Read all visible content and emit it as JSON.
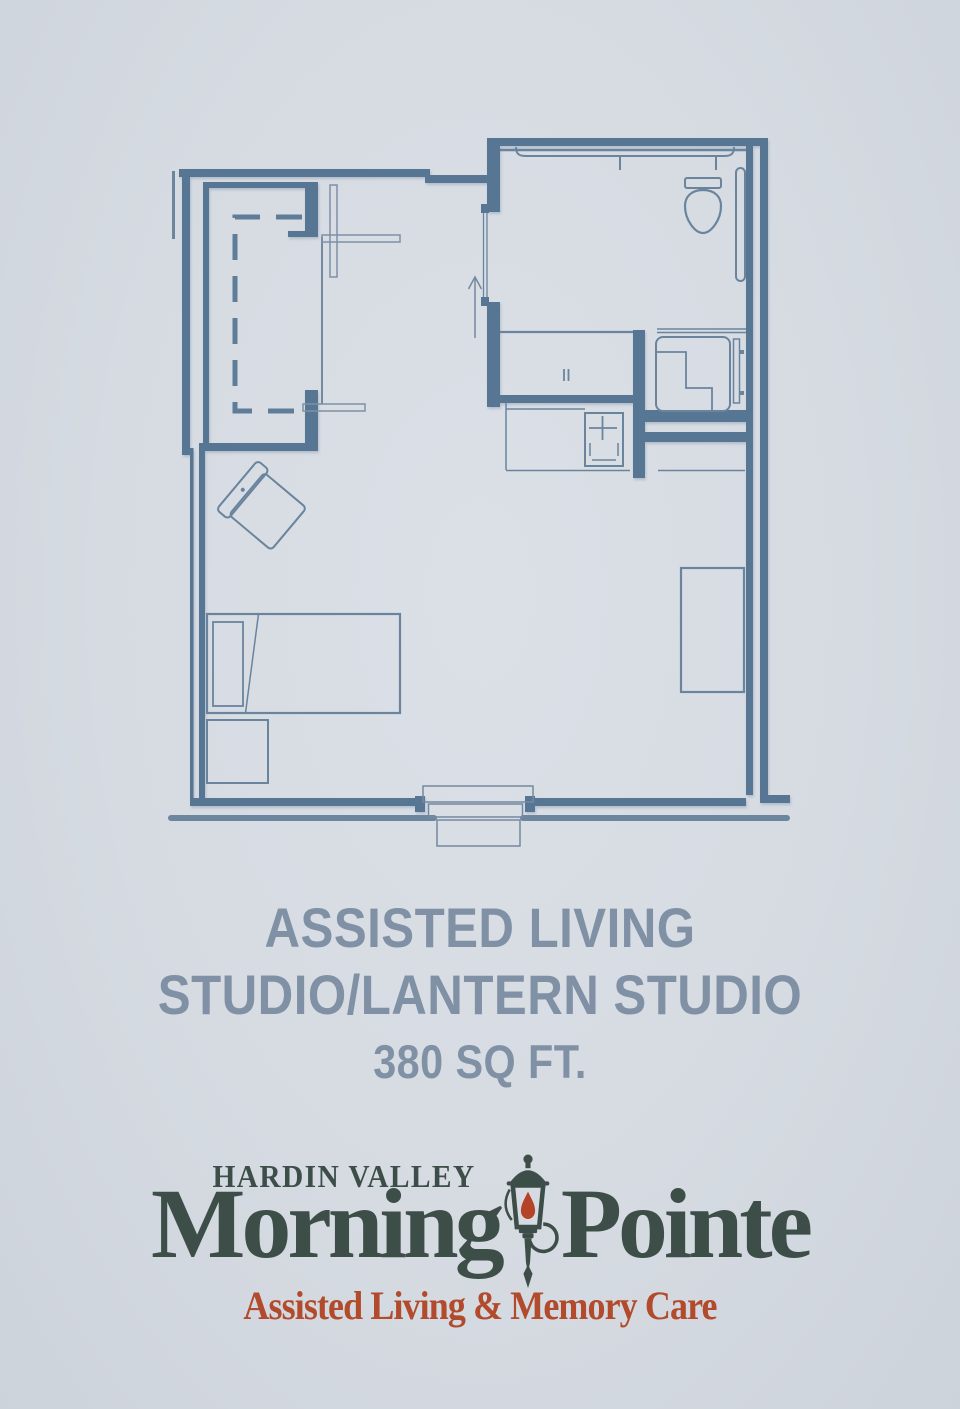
{
  "page": {
    "background_color": "#d6dbe2"
  },
  "floor_plan": {
    "type": "architectural-floor-plan",
    "wall_color": "#577694",
    "furniture_line_color": "#74889f",
    "fixture_line_color": "#6a849e",
    "rooms": [
      "studio-living-sleeping-area",
      "bathroom",
      "closet",
      "kitchenette-counter",
      "entry-vestibule"
    ],
    "fixtures": [
      "toilet",
      "towel-bar",
      "grab-bar",
      "shower-with-bench",
      "shower-door",
      "vanity-counter",
      "sink-with-faucet",
      "bed",
      "pillow",
      "nightstand",
      "armchair",
      "dresser",
      "window",
      "bifold-closet-doors",
      "closet-rod",
      "pocket-door",
      "entry-arrow"
    ]
  },
  "title": {
    "line1": "ASSISTED LIVING",
    "line2": "STUDIO/LANTERN STUDIO",
    "line3": "380 SQ FT.",
    "color": "#8191a5"
  },
  "logo": {
    "community": "HARDIN VALLEY",
    "brand_word_left": "Morning",
    "brand_word_right": "Pointe",
    "tagline": "Assisted Living & Memory Care",
    "brand_color": "#3d4e48",
    "tagline_color": "#b24b2c",
    "lantern_flame_color": "#b5432a",
    "icon": "lantern-icon"
  }
}
